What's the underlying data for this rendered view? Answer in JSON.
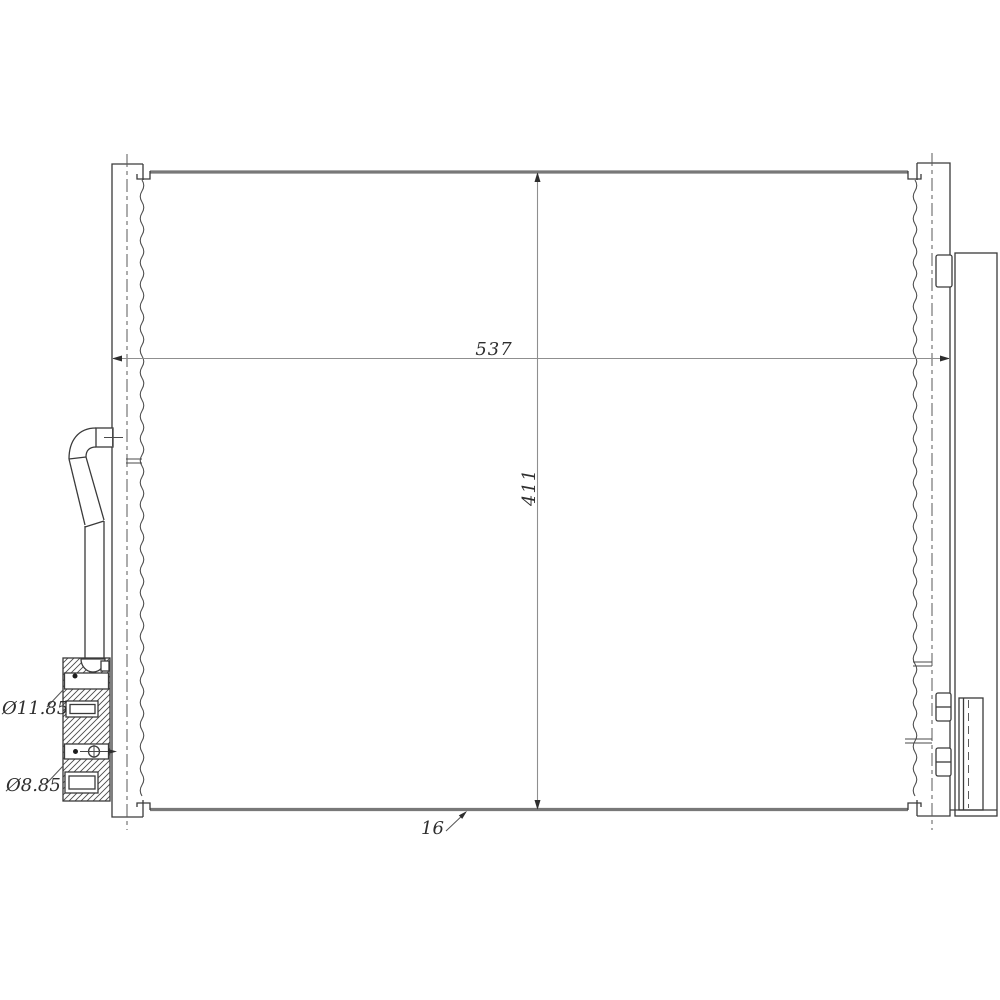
{
  "drawing": {
    "dimension_labels": {
      "overall_width": "537",
      "overall_height": "411",
      "core_depth": "16",
      "upper_port_diameter": "Ø11.85",
      "lower_port_diameter": "Ø8.85"
    },
    "colors": {
      "background": "#ffffff",
      "outline": "#3a3a3a",
      "dimension_line": "#8f8f8f",
      "thick_edge": "#787878",
      "text": "#2e2e2e"
    }
  }
}
